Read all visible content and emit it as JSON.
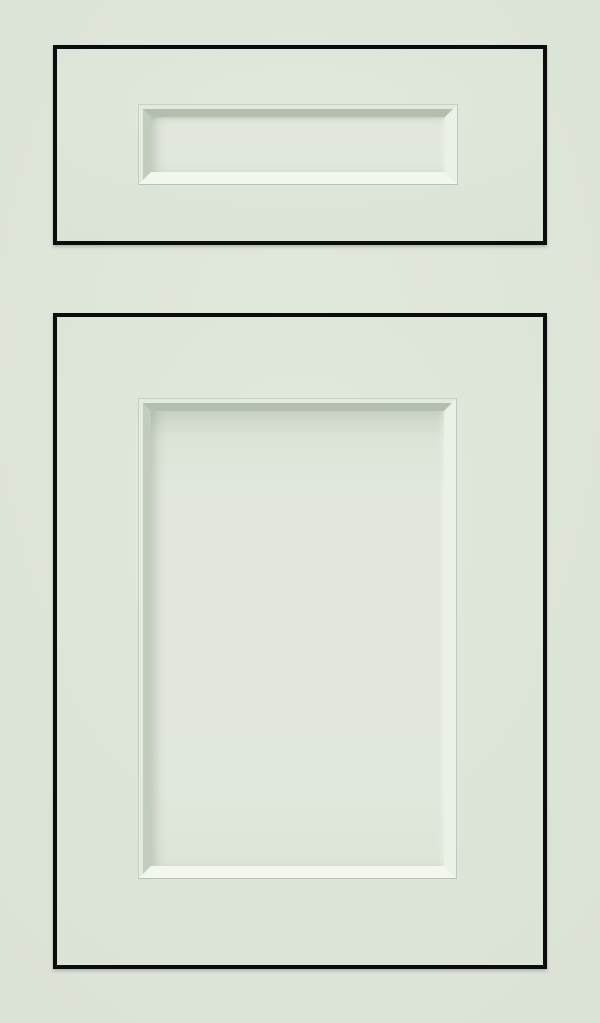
{
  "image": {
    "description": "Product photo of a painted cabinet sample in pale sage green: a horizontal drawer front with a recessed rectangular center panel sits above a large cabinet door with a tall recessed center panel; both pieces are outlined by thin black shadow gaps in an inset frame style.",
    "pieces": [
      {
        "name": "drawer-front",
        "panel_style": "recessed beveled rectangle"
      },
      {
        "name": "cabinet-door",
        "panel_style": "recessed beveled rectangle"
      }
    ]
  },
  "colors": {
    "background": "#dce3d7",
    "face": "#dde5d9",
    "face_light": "#e1e8dc",
    "outline": "#0c0c0c",
    "panel": "#e2e8de",
    "panel_shadow": "#c9d3c3",
    "bevel_shadow_top": "#b4beaf",
    "bevel_shadow_left": "#c2ccbd",
    "bevel_highlight_bottom": "#f2f6ec",
    "bevel_highlight_right": "#ecf1e7",
    "bead_line": "#c6d0c1"
  }
}
